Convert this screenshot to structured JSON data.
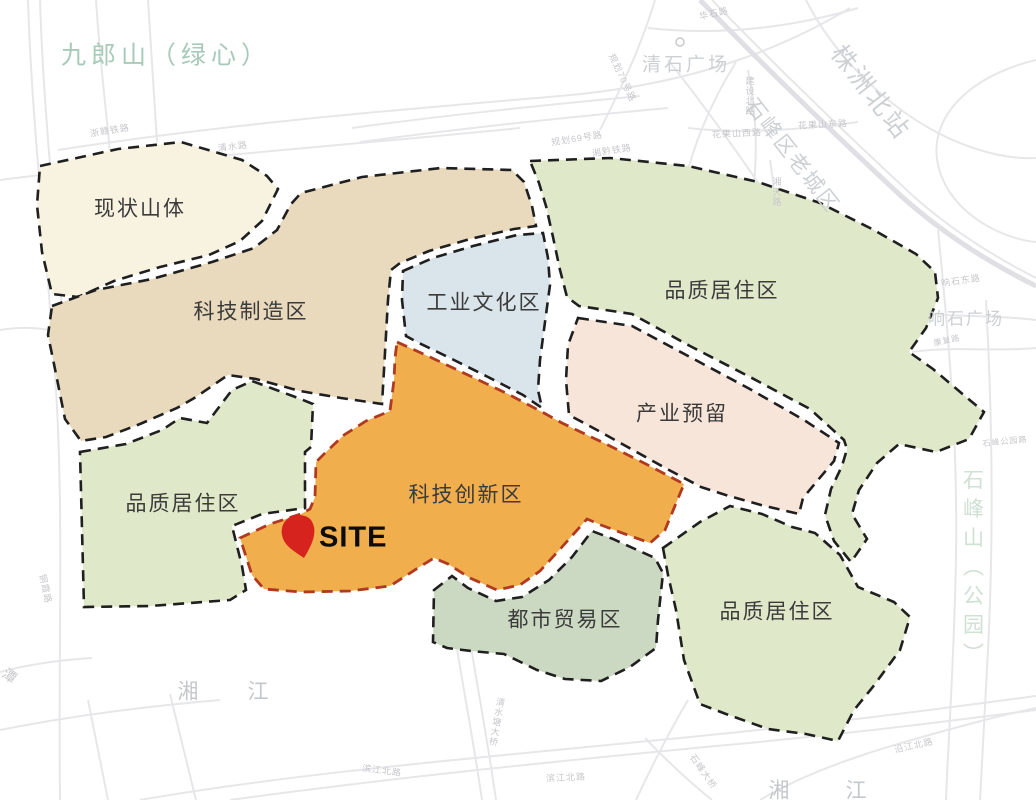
{
  "map": {
    "site": {
      "label": "SITE",
      "pin_color": "#d6231e"
    },
    "zones": [
      {
        "id": "existing-mountain",
        "label": "现状山体",
        "color": "#f8f2e0",
        "border": "#1f1f1f"
      },
      {
        "id": "tech-manufacturing",
        "label": "科技制造区",
        "color": "#e9d9bd",
        "border": "#1f1f1f"
      },
      {
        "id": "industrial-culture",
        "label": "工业文化区",
        "color": "#d9e5ea",
        "border": "#1f1f1f"
      },
      {
        "id": "quality-residential-ne",
        "label": "品质居住区",
        "color": "#dfe9ca",
        "border": "#1f1f1f"
      },
      {
        "id": "industry-reserve",
        "label": "产业预留",
        "color": "#f8e5da",
        "border": "#1f1f1f"
      },
      {
        "id": "tech-innovation",
        "label": "科技创新区",
        "color": "#f1ae4d",
        "border": "#b03a20"
      },
      {
        "id": "urban-trade",
        "label": "都市贸易区",
        "color": "#cbd8c2",
        "border": "#1f1f1f"
      },
      {
        "id": "quality-residential-se",
        "label": "品质居住区",
        "color": "#dfe9ca",
        "border": "#1f1f1f"
      },
      {
        "id": "quality-residential-w",
        "label": "品质居住区",
        "color": "#dfe9ca",
        "border": "#1f1f1f"
      }
    ],
    "landmarks": {
      "jiulangshan": "九郎山（绿心）",
      "qingshi_plaza": "清石广场",
      "zhuzhou_north_station": "株洲北站",
      "shifeng_old_town": "石峰区老城区",
      "xiangshi_plaza": "响石广场",
      "shifeng_park": "石峰山（公园）",
      "river_char_1": "湘",
      "river_char_2": "江"
    },
    "roads": [
      "华石路",
      "浙赣铁路",
      "清水路",
      "规划69号路",
      "湘黔铁路",
      "规划70号路",
      "建设北路",
      "花果山西路",
      "花果山东路",
      "湘天路",
      "响石东路",
      "康复路",
      "石峰公园路",
      "铜霞路",
      "滨江北路",
      "清水塘大桥",
      "沿江北路",
      "石峰大桥",
      "潭"
    ]
  }
}
